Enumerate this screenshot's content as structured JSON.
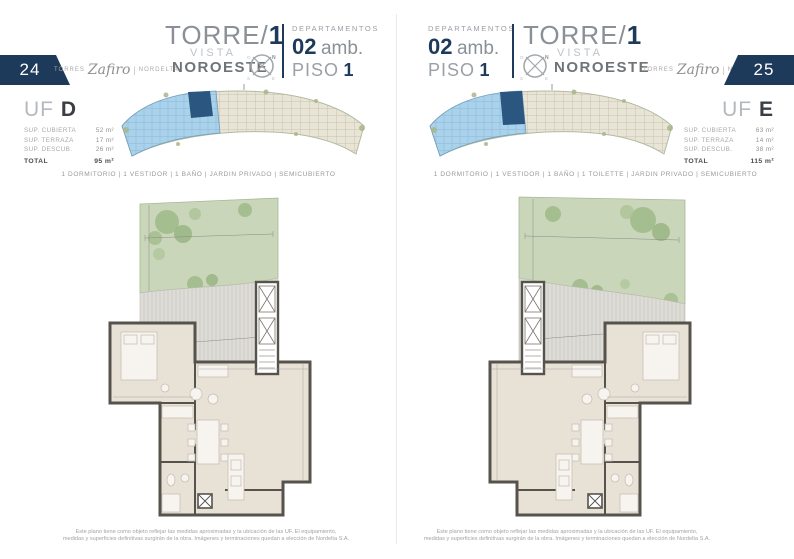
{
  "brand": {
    "torres": "TORRES",
    "zafiro": "Zafiro",
    "separator": "|",
    "nordelta": "NORDELTA"
  },
  "header": {
    "torre_label": "TORRE/",
    "torre_number": "1",
    "vista_label": "VISTA",
    "orientation": "NOROESTE",
    "departamentos_label": "DEPARTAMENTOS",
    "amb_number": "02",
    "amb_label": "amb.",
    "piso_label": "PISO",
    "piso_number": "1",
    "compass": {
      "n": "N",
      "e": "E",
      "s": "S",
      "o": "O"
    }
  },
  "left_page": {
    "page_number": "24",
    "unit": {
      "uf_label": "UF",
      "uf_letter": "D",
      "rows": [
        {
          "label": "SUP. CUBIERTA",
          "value": "52 m²"
        },
        {
          "label": "SUP. TERRAZA",
          "value": "17 m²"
        },
        {
          "label": "SUP. DESCUB.",
          "value": "26 m²"
        }
      ],
      "total_label": "TOTAL",
      "total_value": "95 m²"
    },
    "features": "1 DORMITORIO | 1 VESTIDOR | 1 BAÑO | JARDIN PRIVADO | SEMICUBIERTO"
  },
  "right_page": {
    "page_number": "25",
    "unit": {
      "uf_label": "UF",
      "uf_letter": "E",
      "rows": [
        {
          "label": "SUP. CUBIERTA",
          "value": "63 m²"
        },
        {
          "label": "SUP. TERRAZA",
          "value": "14 m²"
        },
        {
          "label": "SUP. DESCUB.",
          "value": "38 m²"
        }
      ],
      "total_label": "TOTAL",
      "total_value": "115 m²"
    },
    "features": "1 DORMITORIO | 1 VESTIDOR | 1 BAÑO | 1 TOILETTE | JARDIN PRIVADO | SEMICUBIERTO"
  },
  "disclaimer": {
    "line1": "Este plano tiene como objeto reflejar las medidas aproximadas y la ubicación de las UF. El equipamiento,",
    "line2": "medidas y superficies definitivas surgirán de la obra. Imágenes y terminaciones quedan a elección de Nordelta S.A."
  },
  "colors": {
    "navy": "#1d3a5a",
    "tower_highlight": "#a9d2ec",
    "unit_highlight": "#2b5680",
    "footprint_beige": "#e9e5d6",
    "garden_green": "#c9d6b9",
    "interior_beige": "#e8e1d6"
  }
}
